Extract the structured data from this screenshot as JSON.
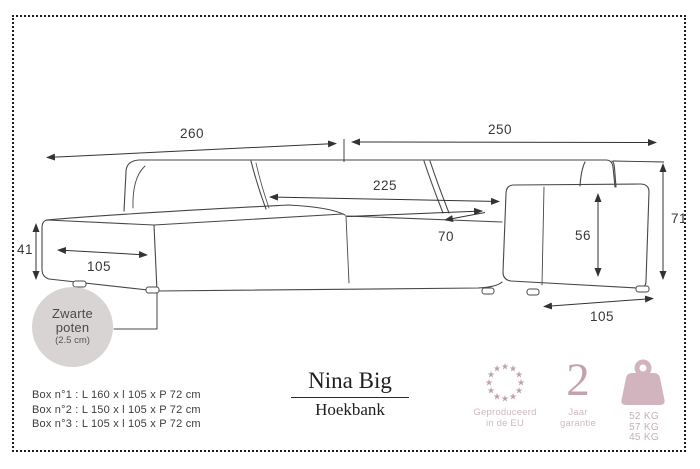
{
  "product": {
    "name": "Nina Big",
    "subtitle": "Hoekbank"
  },
  "dimensions": {
    "total_left": "260",
    "total_right": "250",
    "inner_width": "225",
    "seat_depth": "70",
    "chaise_height": "41",
    "chaise_width": "105",
    "armrest_height": "56",
    "back_height": "71",
    "armrest_depth": "105"
  },
  "legs_note": {
    "line1": "Zwarte",
    "line2": "poten",
    "line3": "(2.5 cm)"
  },
  "boxes": [
    "Box n°1 : L 160 x l 105 x P 72 cm",
    "Box n°2 : L 150 x l 105 x P 72 cm",
    "Box n°3 : L 105 x l 105 x P 72 cm"
  ],
  "badges": {
    "eu": {
      "caption_line1": "Geproduceerd",
      "caption_line2": "in de EU"
    },
    "warranty": {
      "number": "2",
      "caption_line1": "Jaar",
      "caption_line2": "garantie"
    },
    "weights": {
      "items": [
        "52 KG",
        "57 KG",
        "45 KG"
      ]
    }
  },
  "colors": {
    "accent_pink": "#c3a2ae",
    "caption_pink": "#ccbac1",
    "line_art": "#474747",
    "legs_badge_bg": "#d8d4d3"
  }
}
